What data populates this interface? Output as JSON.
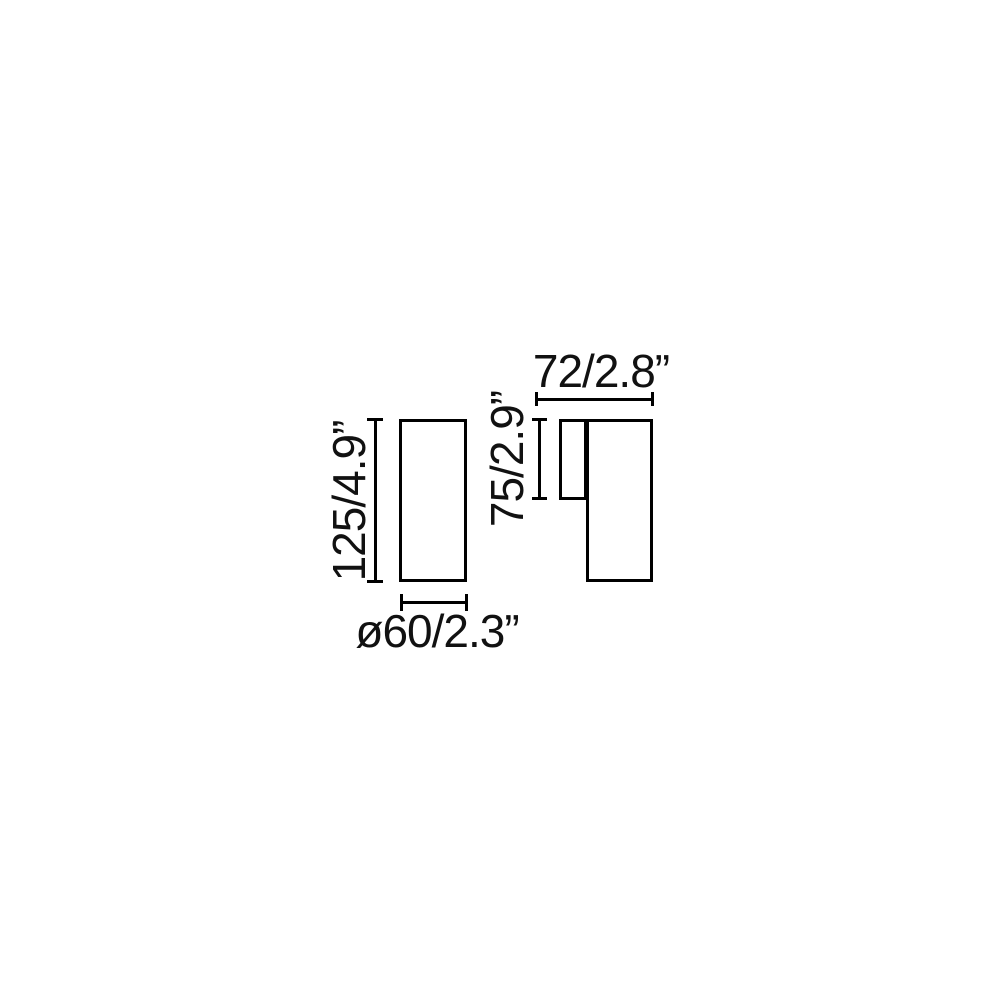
{
  "colors": {
    "background": "#ffffff",
    "line": "#000000",
    "text": "#111111"
  },
  "front_view": {
    "height_label": "125/4.9”",
    "diameter_label": "ø60/2.3”",
    "height_mm": 125,
    "height_in": 4.9,
    "diameter_mm": 60,
    "diameter_in": 2.3
  },
  "side_view": {
    "depth_label": "72/2.8”",
    "height_label": "75/2.9”",
    "depth_mm": 72,
    "depth_in": 2.8,
    "height_mm": 75,
    "height_in": 2.9
  }
}
